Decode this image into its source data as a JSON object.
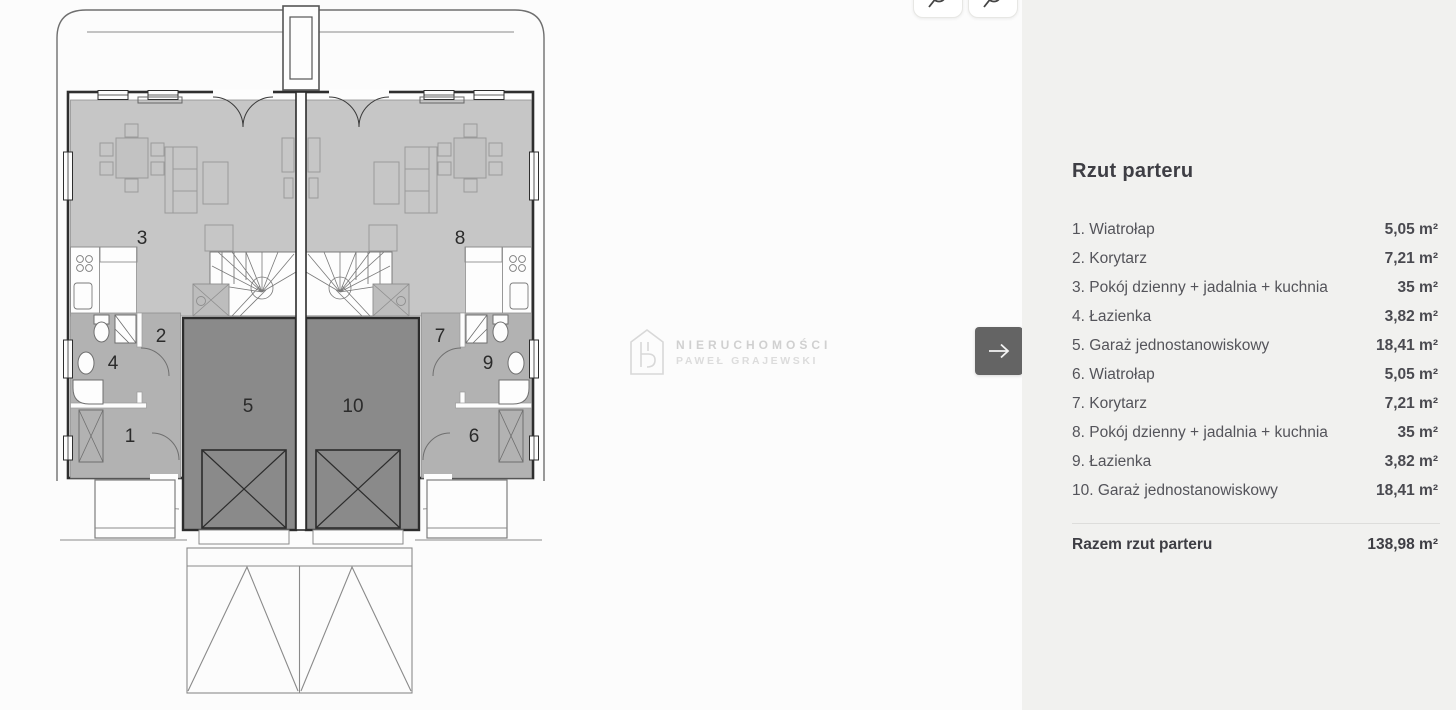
{
  "toolbar": {
    "zoom_in_icon": "magnifier-plus-icon",
    "zoom_out_icon": "magnifier-minus-icon"
  },
  "viewer": {
    "next_button_icon": "arrow-right-icon"
  },
  "plan": {
    "room_numbers": [
      "1",
      "2",
      "3",
      "4",
      "5",
      "6",
      "7",
      "8",
      "9",
      "10"
    ],
    "watermark": {
      "line1": "NIERUCHOMOŚCI",
      "line2": "PAWEŁ GRAJEWSKI"
    }
  },
  "panel": {
    "title": "Rzut parteru",
    "rooms": [
      {
        "label": "1. Wiatrołap",
        "area": "5,05 m²"
      },
      {
        "label": "2. Korytarz",
        "area": "7,21 m²"
      },
      {
        "label": "3. Pokój dzienny + jadalnia + kuchnia",
        "area": "35 m²"
      },
      {
        "label": "4. Łazienka",
        "area": "3,82 m²"
      },
      {
        "label": "5. Garaż jednostanowiskowy",
        "area": "18,41 m²"
      },
      {
        "label": "6. Wiatrołap",
        "area": "5,05 m²"
      },
      {
        "label": "7. Korytarz",
        "area": "7,21 m²"
      },
      {
        "label": "8. Pokój dzienny + jadalnia + kuchnia",
        "area": "35 m²"
      },
      {
        "label": "9. Łazienka",
        "area": "3,82 m²"
      },
      {
        "label": "10. Garaż jednostanowiskowy",
        "area": "18,41 m²"
      }
    ],
    "total_label": "Razem rzut parteru",
    "total_area": "138,98 m²"
  },
  "colors": {
    "panel_bg": "#f1f1ef",
    "next_button_bg": "#646464",
    "living_zone": "#c6c6c6",
    "entry_zone": "#b2b2b2",
    "garage_zone": "#8a8a8a"
  }
}
